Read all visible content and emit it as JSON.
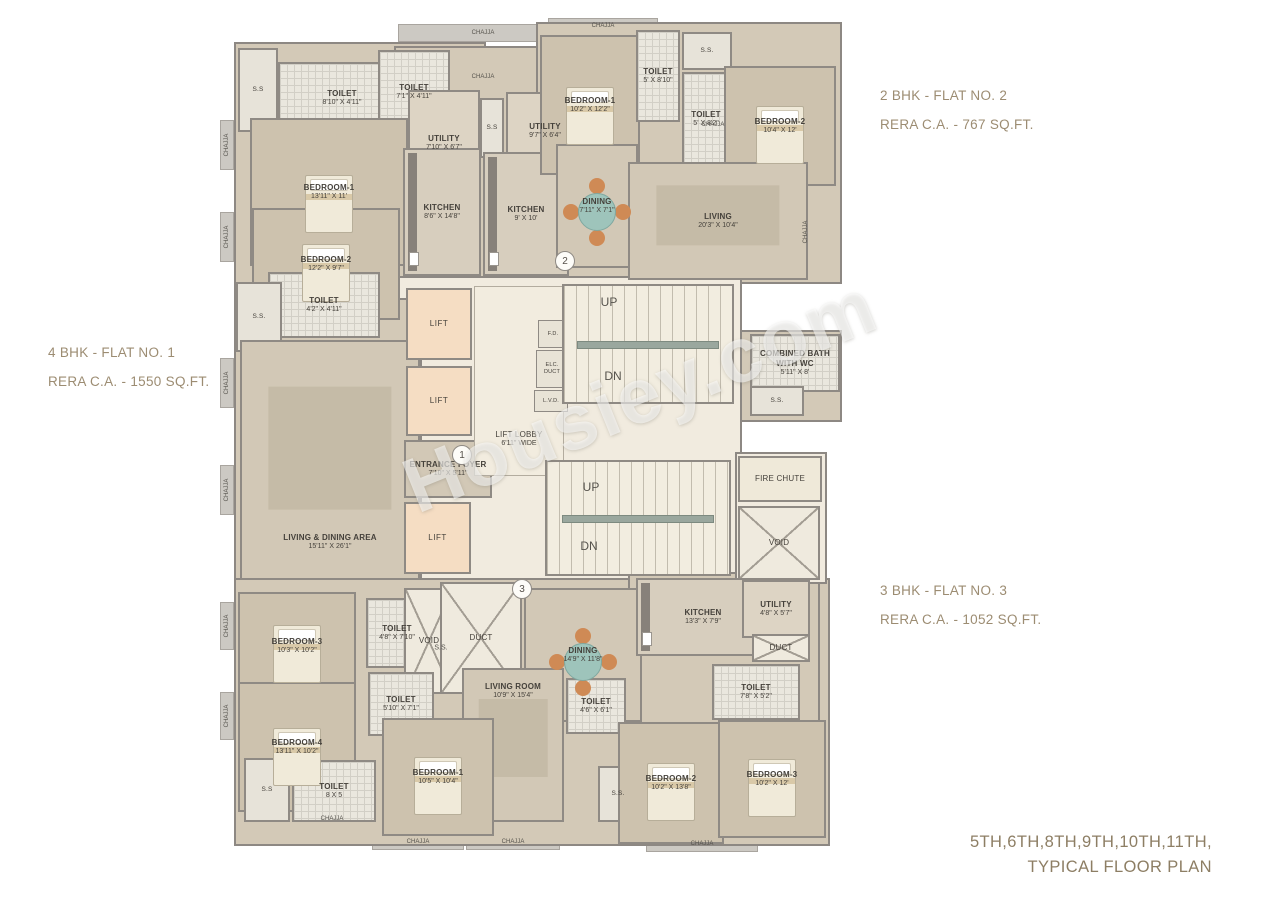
{
  "annotations": {
    "flat1": {
      "line1": "4 BHK - FLAT NO. 1",
      "line2": "RERA C.A. - 1550 SQ.FT."
    },
    "flat2": {
      "line1": "2 BHK - FLAT NO. 2",
      "line2": "RERA C.A. - 767 SQ.FT."
    },
    "flat3": {
      "line1": "3 BHK - FLAT NO. 3",
      "line2": "RERA C.A. - 1052 SQ.FT."
    },
    "title": {
      "line1": "5TH,6TH,8TH,9TH,10TH,11TH,",
      "line2": "TYPICAL FLOOR PLAN"
    },
    "watermark": "Housiey.com"
  },
  "colors": {
    "annotation_text": "#9c8c72",
    "wall": "#8f8a84",
    "floor_beige": "#d3c9b7",
    "core_cream": "#f1ebdf",
    "lift_peach": "#f5ddc3",
    "accent_wood": "#cf8a55",
    "accent_teal": "#9ec4bb"
  },
  "plan": {
    "rooms": [
      {
        "id": "ss-top-left",
        "kind": "ss",
        "name": "S.S",
        "x": 238,
        "y": 48,
        "w": 40,
        "h": 84
      },
      {
        "id": "toilet-f1-a",
        "kind": "toilet",
        "name": "TOILET",
        "dims": "8'10\" X 4'11\"",
        "x": 278,
        "y": 62,
        "w": 128,
        "h": 72
      },
      {
        "id": "toilet-f1-b",
        "kind": "toilet",
        "name": "TOILET",
        "dims": "7'1\" X 4'11\"",
        "x": 378,
        "y": 50,
        "w": 72,
        "h": 84
      },
      {
        "id": "bedroom-1-f1",
        "kind": "bedroom",
        "name": "BEDROOM-1",
        "dims": "13'11\" X 11'",
        "x": 250,
        "y": 118,
        "w": 158,
        "h": 148
      },
      {
        "id": "utility-f1",
        "kind": "utility",
        "name": "UTILITY",
        "dims": "7'10\" X 6'7\"",
        "x": 408,
        "y": 90,
        "w": 72,
        "h": 106
      },
      {
        "id": "ss-utility",
        "kind": "ss",
        "name": "S.S",
        "x": 480,
        "y": 98,
        "w": 24,
        "h": 60
      },
      {
        "id": "utility-f2",
        "kind": "utility",
        "name": "UTILITY",
        "dims": "9'7\" X 6'4\"",
        "x": 506,
        "y": 92,
        "w": 78,
        "h": 78
      },
      {
        "id": "kitchen-f1",
        "kind": "kitchen",
        "name": "KITCHEN",
        "dims": "8'6\" X 14'8\"",
        "x": 403,
        "y": 148,
        "w": 78,
        "h": 128
      },
      {
        "id": "kitchen-f2",
        "kind": "kitchen",
        "name": "KITCHEN",
        "dims": "9' X 10'",
        "x": 483,
        "y": 152,
        "w": 86,
        "h": 124
      },
      {
        "id": "bedroom-2-f1",
        "kind": "bedroom",
        "name": "BEDROOM-2",
        "dims": "12'2\" X 9'7\"",
        "x": 252,
        "y": 208,
        "w": 148,
        "h": 112
      },
      {
        "id": "toilet-f1-c",
        "kind": "toilet",
        "name": "TOILET",
        "dims": "4'2\" X 4'11\"",
        "x": 268,
        "y": 272,
        "w": 112,
        "h": 66
      },
      {
        "id": "ss-left",
        "kind": "ss",
        "name": "S.S.",
        "x": 236,
        "y": 282,
        "w": 46,
        "h": 70
      },
      {
        "id": "living-dining-f1",
        "kind": "living",
        "name": "LIVING & DINING AREA",
        "dims": "15'11\" X 26'1\"",
        "x": 240,
        "y": 340,
        "w": 180,
        "h": 240,
        "labelPos": "bottom"
      },
      {
        "id": "lift-1",
        "kind": "lift",
        "name": "LIFT",
        "x": 406,
        "y": 288,
        "w": 66,
        "h": 72
      },
      {
        "id": "lift-2",
        "kind": "lift",
        "name": "LIFT",
        "x": 406,
        "y": 366,
        "w": 66,
        "h": 70
      },
      {
        "id": "entrance-foyer",
        "kind": "foyer",
        "name": "ENTRANCE FOYER",
        "dims": "7'10\" X 5'11\"",
        "x": 404,
        "y": 440,
        "w": 88,
        "h": 58
      },
      {
        "id": "lift-3",
        "kind": "lift",
        "name": "LIFT",
        "x": 404,
        "y": 502,
        "w": 67,
        "h": 72
      },
      {
        "id": "lift-lobby",
        "kind": "lobby",
        "name": "LIFT LOBBY",
        "dims": "6'11\" WIDE",
        "x": 474,
        "y": 286,
        "w": 90,
        "h": 190,
        "labelPos": "bottom"
      },
      {
        "id": "fd-duct",
        "kind": "tiny",
        "name": "F.D.",
        "x": 538,
        "y": 320,
        "w": 30,
        "h": 28
      },
      {
        "id": "elc-duct",
        "kind": "tiny",
        "name": "ELC. DUCT",
        "x": 536,
        "y": 350,
        "w": 32,
        "h": 38
      },
      {
        "id": "lvd-duct",
        "kind": "tiny",
        "name": "L.V.D.",
        "x": 534,
        "y": 390,
        "w": 34,
        "h": 22
      },
      {
        "id": "stair-1",
        "kind": "stair",
        "name": "",
        "x": 562,
        "y": 284,
        "w": 172,
        "h": 120
      },
      {
        "id": "stair-2",
        "kind": "stair",
        "name": "",
        "x": 545,
        "y": 460,
        "w": 186,
        "h": 116
      },
      {
        "id": "combined-bath",
        "kind": "bath",
        "name": "COMBINED BATH WITH WC",
        "dims": "5'11\" X 8'",
        "x": 750,
        "y": 334,
        "w": 90,
        "h": 58
      },
      {
        "id": "ss-bath",
        "kind": "ss",
        "name": "S.S.",
        "x": 750,
        "y": 386,
        "w": 54,
        "h": 30
      },
      {
        "id": "fire-chute",
        "kind": "firechute",
        "name": "FIRE CHUTE",
        "x": 738,
        "y": 456,
        "w": 84,
        "h": 46
      },
      {
        "id": "void-right",
        "kind": "void",
        "name": "VOID",
        "x": 738,
        "y": 506,
        "w": 82,
        "h": 74
      },
      {
        "id": "bedroom-1-f2",
        "kind": "bedroom",
        "name": "BEDROOM-1",
        "dims": "10'2\" X 12'2\"",
        "x": 540,
        "y": 35,
        "w": 100,
        "h": 140
      },
      {
        "id": "toilet-f2-a",
        "kind": "toilet",
        "name": "TOILET",
        "dims": "5' X 8'10\"",
        "x": 636,
        "y": 30,
        "w": 44,
        "h": 92
      },
      {
        "id": "ss-f2",
        "kind": "ss",
        "name": "S.S.",
        "x": 682,
        "y": 32,
        "w": 50,
        "h": 38
      },
      {
        "id": "toilet-f2-b",
        "kind": "toilet",
        "name": "TOILET",
        "dims": "5' X 8'2\"",
        "x": 682,
        "y": 72,
        "w": 48,
        "h": 94
      },
      {
        "id": "bedroom-2-f2",
        "kind": "bedroom",
        "name": "BEDROOM-2",
        "dims": "10'4\" X 12'",
        "x": 724,
        "y": 66,
        "w": 112,
        "h": 120
      },
      {
        "id": "dining-f2",
        "kind": "dining",
        "name": "DINING",
        "dims": "7'11\" X 7'1\"",
        "x": 556,
        "y": 144,
        "w": 82,
        "h": 124
      },
      {
        "id": "living-f2",
        "kind": "living",
        "name": "LIVING",
        "dims": "20'3\" X 10'4\"",
        "x": 628,
        "y": 162,
        "w": 180,
        "h": 118
      },
      {
        "id": "bedroom-3-f1",
        "kind": "bedroom",
        "name": "BEDROOM-3",
        "dims": "10'3\" X 10'2\"",
        "x": 238,
        "y": 592,
        "w": 118,
        "h": 108
      },
      {
        "id": "bedroom-4-f1",
        "kind": "bedroom",
        "name": "BEDROOM-4",
        "dims": "13'11\" X 10'2\"",
        "x": 238,
        "y": 682,
        "w": 118,
        "h": 130
      },
      {
        "id": "toilet-f1-d",
        "kind": "toilet",
        "name": "TOILET",
        "dims": "4'8\" X 7'10\"",
        "x": 366,
        "y": 598,
        "w": 62,
        "h": 70
      },
      {
        "id": "void-center",
        "kind": "void",
        "name": "VOID",
        "x": 404,
        "y": 588,
        "w": 50,
        "h": 106
      },
      {
        "id": "duct-center",
        "kind": "duct",
        "name": "DUCT",
        "x": 440,
        "y": 582,
        "w": 82,
        "h": 112
      },
      {
        "id": "toilet-f1-e",
        "kind": "toilet",
        "name": "TOILET",
        "dims": "5'10\" X 7'1\"",
        "x": 368,
        "y": 672,
        "w": 66,
        "h": 64
      },
      {
        "id": "dining-f3",
        "kind": "dining",
        "name": "DINING",
        "dims": "14'9\" X 11'8\"",
        "x": 524,
        "y": 588,
        "w": 118,
        "h": 134
      },
      {
        "id": "kitchen-f3",
        "kind": "kitchen",
        "name": "KITCHEN",
        "dims": "13'3\" X 7'9\"",
        "x": 636,
        "y": 578,
        "w": 134,
        "h": 78
      },
      {
        "id": "utility-f3",
        "kind": "utility",
        "name": "UTILITY",
        "dims": "4'8\" X 5'7\"",
        "x": 742,
        "y": 580,
        "w": 68,
        "h": 58
      },
      {
        "id": "duct-f3",
        "kind": "duct",
        "name": "DUCT",
        "x": 752,
        "y": 634,
        "w": 58,
        "h": 28
      },
      {
        "id": "toilet-f3-a",
        "kind": "toilet",
        "name": "TOILET",
        "dims": "7'8\" X 5'2\"",
        "x": 712,
        "y": 664,
        "w": 88,
        "h": 56
      },
      {
        "id": "living-room-f3",
        "kind": "living",
        "name": "LIVING ROOM",
        "dims": "10'9\" X 15'4\"",
        "x": 462,
        "y": 668,
        "w": 102,
        "h": 154,
        "labelPos": "top"
      },
      {
        "id": "toilet-f3-b",
        "kind": "toilet",
        "name": "TOILET",
        "dims": "4'6\" X 6'1\"",
        "x": 566,
        "y": 678,
        "w": 60,
        "h": 56
      },
      {
        "id": "bedroom-1-f3",
        "kind": "bedroom",
        "name": "BEDROOM-1",
        "dims": "10'5\" X 10'4\"",
        "x": 382,
        "y": 718,
        "w": 112,
        "h": 118
      },
      {
        "id": "ss-f3",
        "kind": "ss",
        "name": "S.S.",
        "x": 598,
        "y": 766,
        "w": 40,
        "h": 56
      },
      {
        "id": "bedroom-2-f3",
        "kind": "bedroom",
        "name": "BEDROOM-2",
        "dims": "10'2\" X 13'8\"",
        "x": 618,
        "y": 722,
        "w": 106,
        "h": 122
      },
      {
        "id": "bedroom-3-f3",
        "kind": "bedroom",
        "name": "BEDROOM-3",
        "dims": "10'2\" X 12'",
        "x": 718,
        "y": 720,
        "w": 108,
        "h": 118
      },
      {
        "id": "toilet-f1-f",
        "kind": "toilet",
        "name": "TOILET",
        "dims": "8 X 5",
        "x": 292,
        "y": 760,
        "w": 84,
        "h": 62
      },
      {
        "id": "ss-bottom-left",
        "kind": "ss",
        "name": "S.S",
        "x": 244,
        "y": 758,
        "w": 46,
        "h": 64
      }
    ],
    "labels": [
      {
        "text": "UP",
        "x": 609,
        "y": 302,
        "size": 12
      },
      {
        "text": "DN",
        "x": 613,
        "y": 376,
        "size": 12
      },
      {
        "text": "UP",
        "x": 591,
        "y": 487,
        "size": 12
      },
      {
        "text": "DN",
        "x": 589,
        "y": 546,
        "size": 12
      },
      {
        "text": "S.S.",
        "x": 441,
        "y": 648,
        "size": 7
      },
      {
        "text": "CHAJJA",
        "x": 483,
        "y": 33,
        "size": 6
      },
      {
        "text": "CHAJJA",
        "x": 483,
        "y": 77,
        "size": 6
      },
      {
        "text": "CHAJJA",
        "x": 603,
        "y": 26,
        "size": 6
      },
      {
        "text": "CHAJJA",
        "x": 713,
        "y": 125,
        "size": 6
      },
      {
        "text": "CHAJJA",
        "x": 332,
        "y": 819,
        "size": 6
      },
      {
        "text": "CHAJJA",
        "x": 418,
        "y": 842,
        "size": 6
      },
      {
        "text": "CHAJJA",
        "x": 513,
        "y": 842,
        "size": 6
      },
      {
        "text": "CHAJJA",
        "x": 702,
        "y": 844,
        "size": 6
      },
      {
        "text": "CHAJJA",
        "x": 227,
        "y": 145,
        "size": 6,
        "rot": -90
      },
      {
        "text": "CHAJJA",
        "x": 227,
        "y": 237,
        "size": 6,
        "rot": -90
      },
      {
        "text": "CHAJJA",
        "x": 227,
        "y": 383,
        "size": 6,
        "rot": -90
      },
      {
        "text": "CHAJJA",
        "x": 227,
        "y": 490,
        "size": 6,
        "rot": -90
      },
      {
        "text": "CHAJJA",
        "x": 227,
        "y": 626,
        "size": 6,
        "rot": -90
      },
      {
        "text": "CHAJJA",
        "x": 227,
        "y": 716,
        "size": 6,
        "rot": -90
      },
      {
        "text": "CHAJJA",
        "x": 806,
        "y": 232,
        "size": 6,
        "rot": -90
      }
    ],
    "markers": [
      {
        "n": "1",
        "x": 462,
        "y": 455
      },
      {
        "n": "2",
        "x": 565,
        "y": 261
      },
      {
        "n": "3",
        "x": 522,
        "y": 589
      }
    ]
  }
}
